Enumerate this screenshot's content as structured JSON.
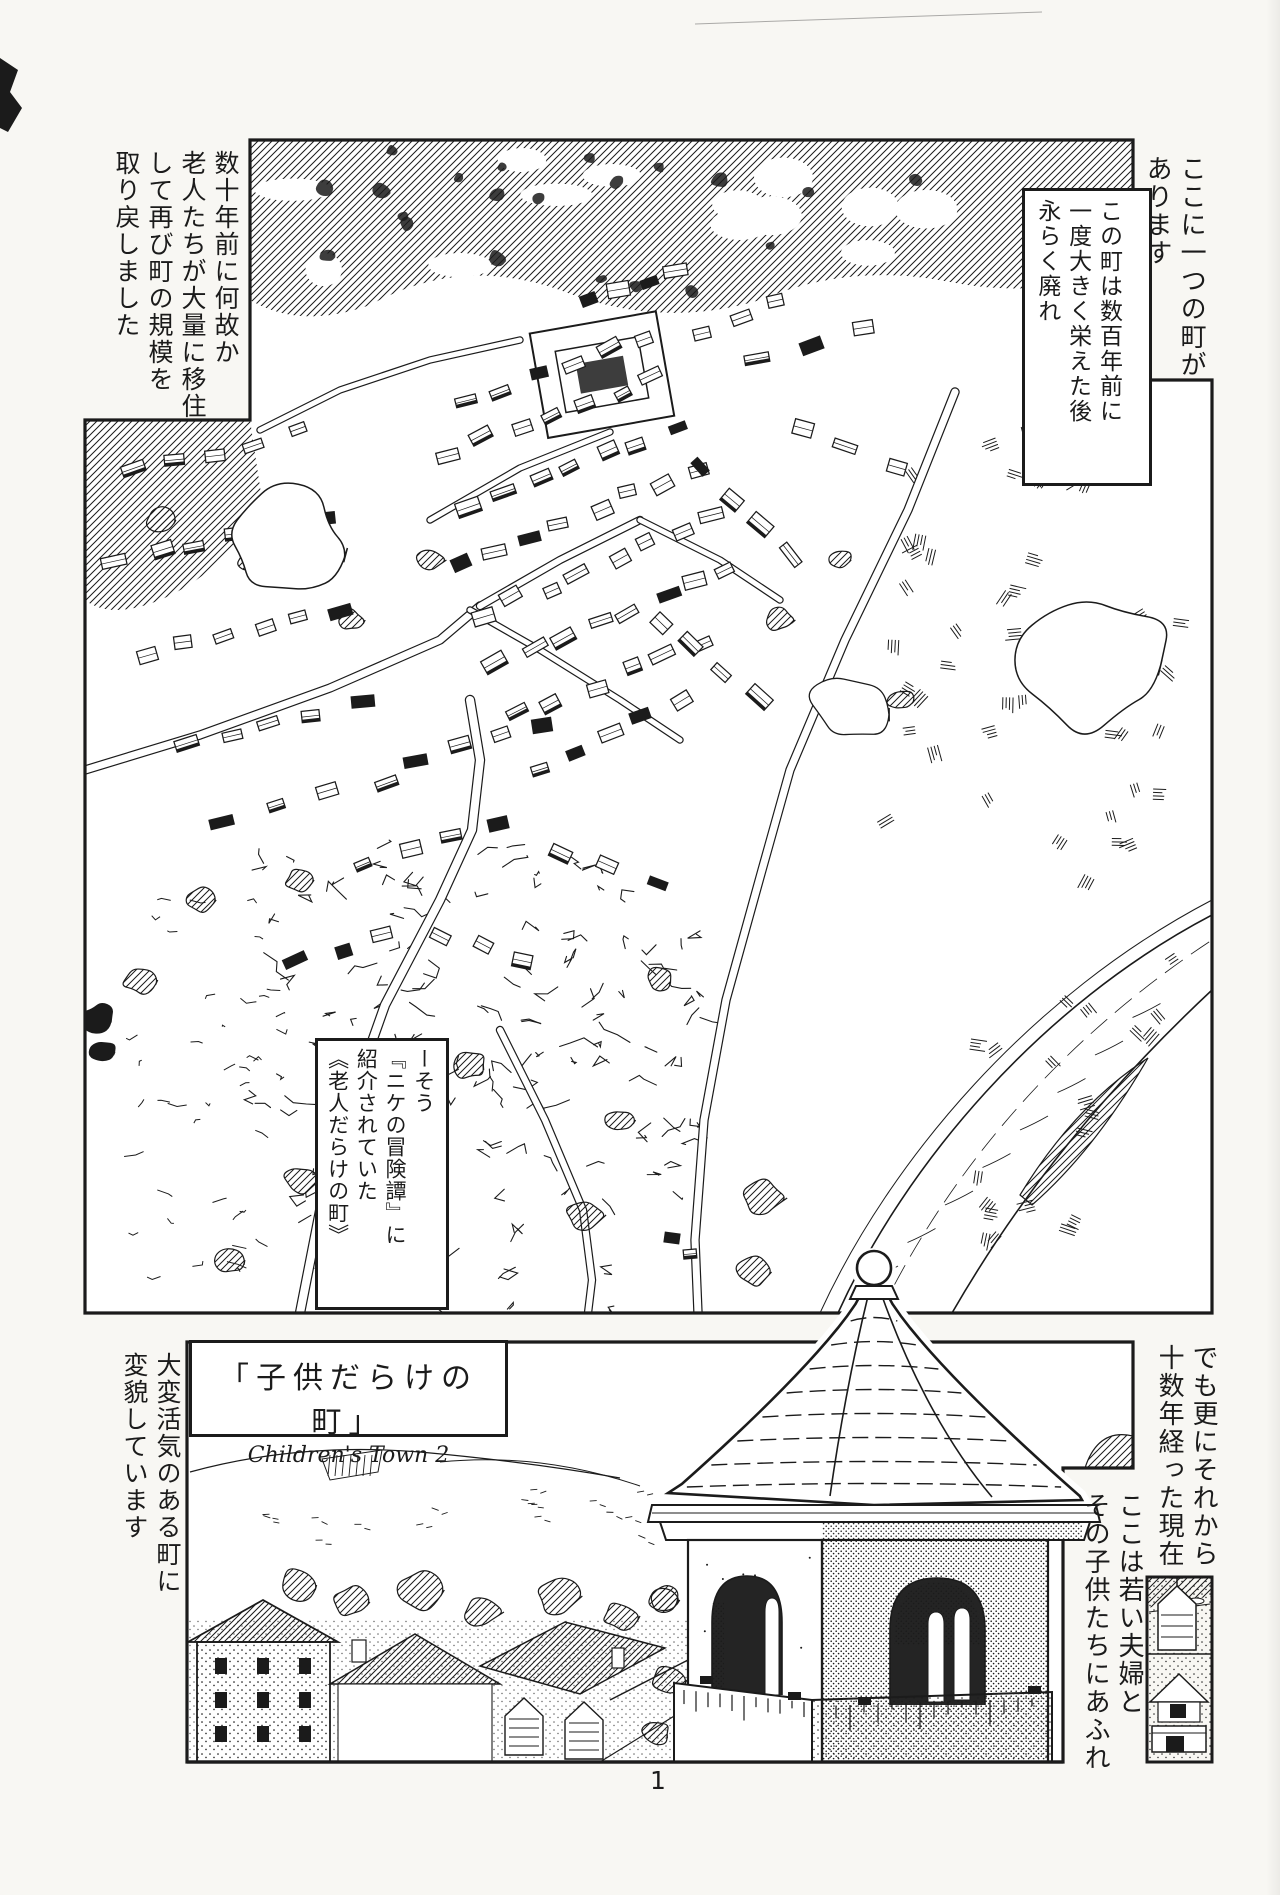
{
  "colors": {
    "ink": "#1b1b1b",
    "paper": "#f8f7f3",
    "panel_bg": "#ffffff"
  },
  "page": {
    "number": "1"
  },
  "title": {
    "jp": "「子供だらけの町」",
    "en": "Children's Town 2"
  },
  "narration": {
    "top_right_outer": {
      "lines": [
        "ここに一つの町が",
        "あります"
      ]
    },
    "top_right_box": {
      "lines": [
        "この町は数百年前に",
        "一度大きく栄えた後",
        "永らく廃れ"
      ]
    },
    "top_left": {
      "lines": [
        "数十年前に何故か",
        "老人たちが大量に移住",
        "して再び町の規模を",
        "取り戻しました"
      ]
    },
    "mid_box": {
      "lines": [
        "ーそう",
        "『ニケの冒険譚』に",
        "紹介されていた",
        "《老人だらけの町》"
      ]
    },
    "bottom_left": {
      "lines": [
        "大変活気のある町に",
        "変貌しています"
      ]
    },
    "bottom_right_outer": {
      "lines": [
        "でも更にそれから",
        "十数年経った現在"
      ]
    },
    "bottom_right_inner": {
      "lines": [
        "ここは若い夫婦と",
        "その子供たちにあふれ"
      ]
    }
  }
}
